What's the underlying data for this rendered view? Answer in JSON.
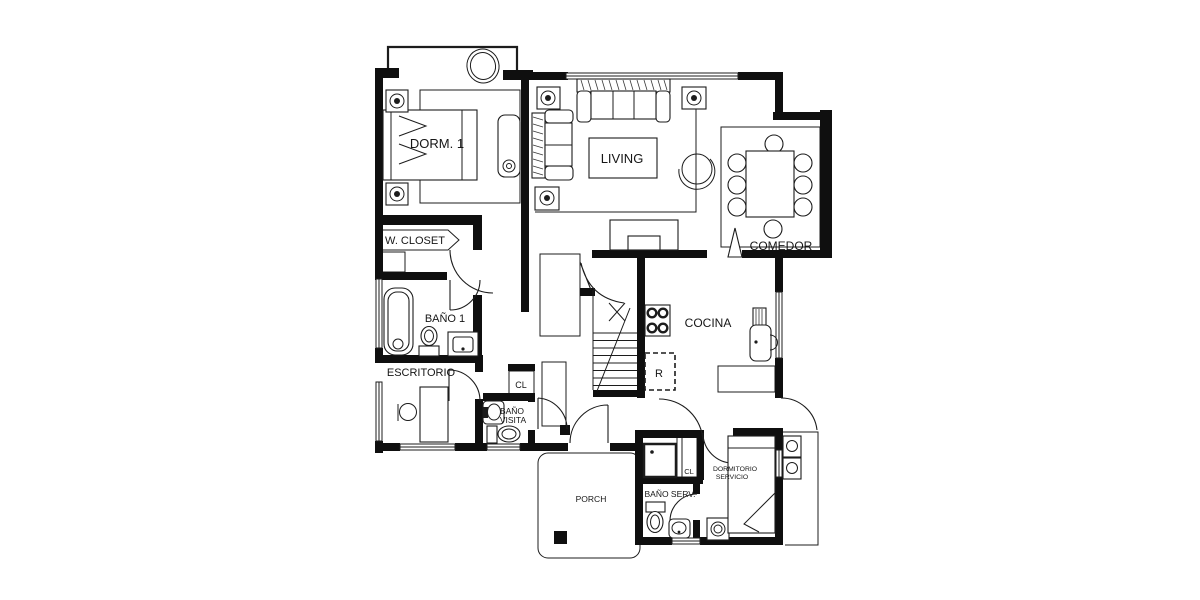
{
  "colors": {
    "ink": "#1c1c1c",
    "wall": "#0f0f0f",
    "background": "#ffffff"
  },
  "rooms": {
    "dorm1": "DORM. 1",
    "living": "LIVING",
    "comedor": "COMEDOR",
    "walk_in_closet": "W. CLOSET",
    "bano1": "BAÑO 1",
    "escritorio": "ESCRITORIO",
    "closet_hall": "CL",
    "bano_visita_l1": "BAÑO",
    "bano_visita_l2": "VISITA",
    "cocina": "COCINA",
    "refrigerator": "R",
    "porch": "PORCH",
    "closet_servicio": "CL",
    "dormitorio_servicio_l1": "DORMITORIO",
    "dormitorio_servicio_l2": "SERVICIO",
    "bano_servicio": "BAÑO SERV."
  }
}
